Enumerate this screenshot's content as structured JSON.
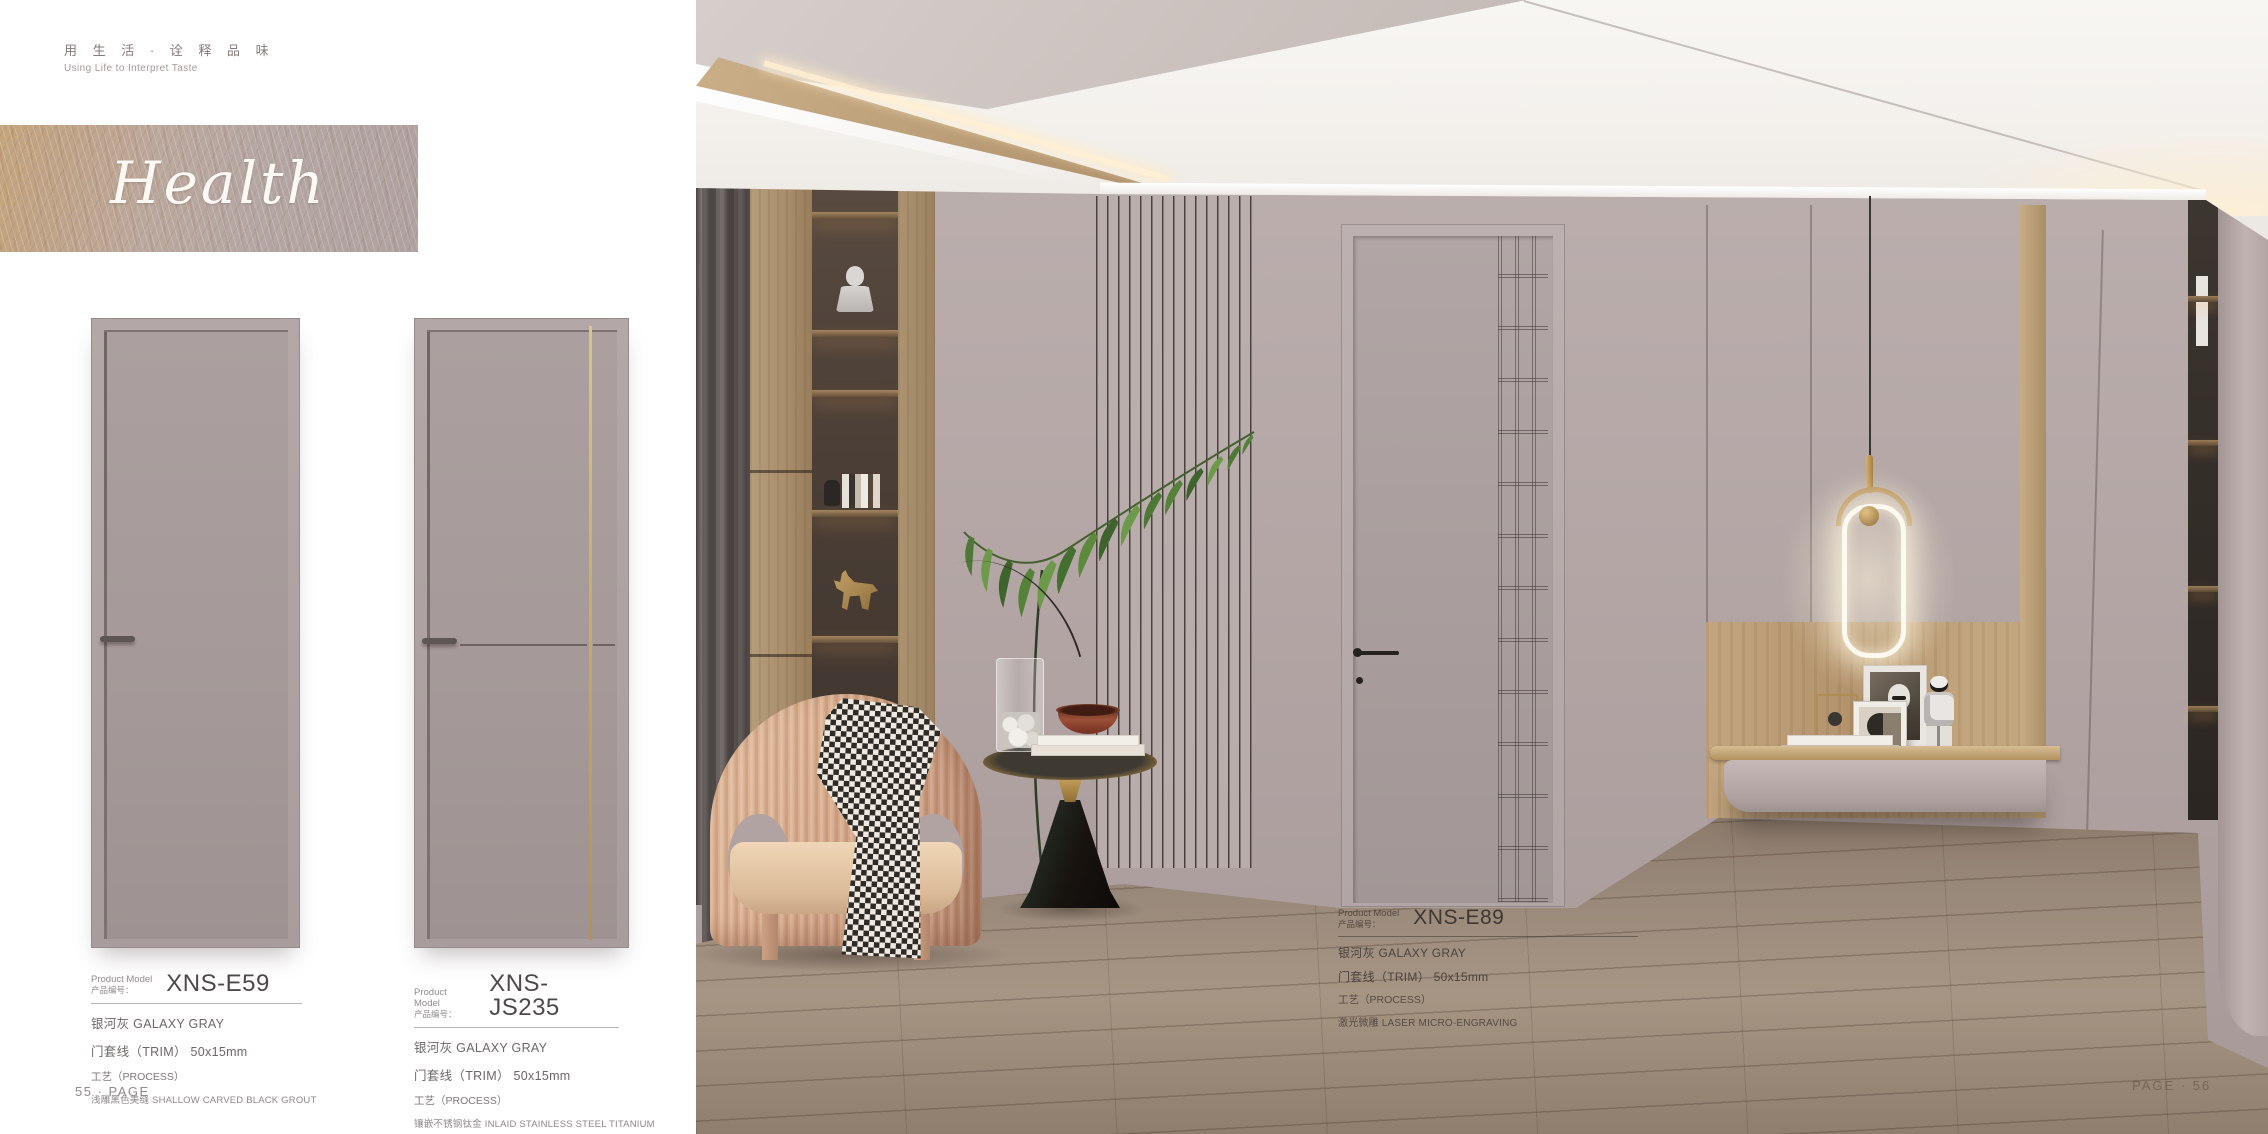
{
  "page": {
    "tagline_zh": "用 生 活 · 诠 释 品 味",
    "tagline_en": "Using Life to Interpret Taste",
    "banner_title": "Health",
    "page_left": "55 · PAGE",
    "page_right": "PAGE · 56"
  },
  "labels": {
    "model_en": "Product Model",
    "model_zh": "产品编号："
  },
  "products": [
    {
      "model": "XNS-E59",
      "color": "银河灰 GALAXY GRAY",
      "trim": "门套线（TRIM） 50x15mm",
      "process": "工艺（PROCESS）",
      "details": [
        "浅雕黑色美缝 SHALLOW CARVED BLACK GROUT"
      ]
    },
    {
      "model": "XNS-JS235",
      "color": "银河灰 GALAXY GRAY",
      "trim": "门套线（TRIM） 50x15mm",
      "process": "工艺（PROCESS）",
      "details": [
        "镶嵌不锈钢钛金 INLAID STAINLESS STEEL TITANIUM",
        "浅雕黑色美缝 SHALLOW CARVED BLACK GROUT"
      ]
    },
    {
      "model": "XNS-E89",
      "color": "银河灰 GALAXY GRAY",
      "trim": "门套线（TRIM） 50x15mm",
      "process": "工艺（PROCESS）",
      "details": [
        "激光微雕 LASER MICRO-ENGRAVING"
      ]
    }
  ],
  "colors": {
    "door_gray": "#a89d9c",
    "wall_mauve": "#b3a6a5",
    "titanium_gold": "#c9ab63",
    "wood_floor": "#99897a",
    "shelf_wood": "#ab9070",
    "chair_blush": "#d8ab8a"
  }
}
